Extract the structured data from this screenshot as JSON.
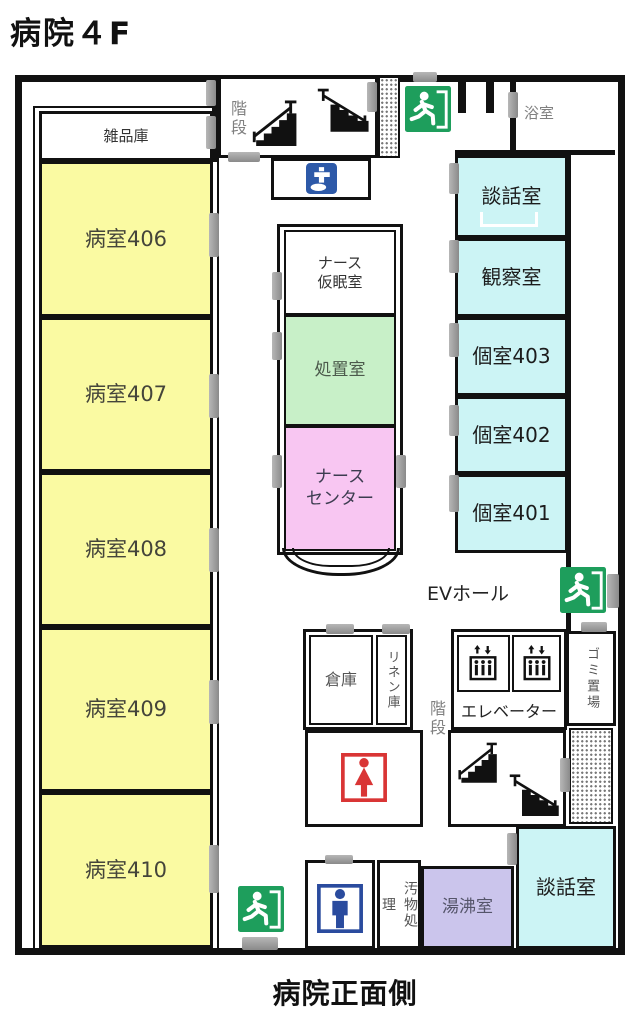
{
  "title": "病院４F",
  "caption": "病院正面側",
  "rooms": {
    "zappinko": "雑品庫",
    "r406": "病室406",
    "r407": "病室407",
    "r408": "病室408",
    "r409": "病室409",
    "r410": "病室410",
    "kaidan_top": "階段",
    "yokushitsu": "浴室",
    "danwa_top": "談話室",
    "kansatsu": "観察室",
    "k403": "個室403",
    "k402": "個室402",
    "k401": "個室401",
    "nurse_nap_line1": "ナース",
    "nurse_nap_line2": "仮眠室",
    "shochi": "処置室",
    "nurse_center_line1": "ナース",
    "nurse_center_line2": "センター",
    "ev_hall": "EVホール",
    "soko": "倉庫",
    "linen": "リネン庫",
    "elevator": "エレベーター",
    "gomi": "ゴミ置場",
    "kaidan_bottom": "階段",
    "obutsu": "汚物処理",
    "yuwakashi": "湯沸室",
    "danwa_bottom": "談話室"
  },
  "icons": {
    "emergency_exit": "emergency-exit-running-man",
    "stairs_up": "stairs-up",
    "stairs_down": "stairs-down",
    "elevator": "elevator-cabin-with-people",
    "female_toilet": "female-toilet",
    "male_toilet": "male-toilet",
    "hand_wash": "hand-washing-faucet"
  },
  "colors": {
    "ward_yellow": "#FAFAA2",
    "room_cyan": "#CCF4F5",
    "treatment_green": "#C8F0C8",
    "nurse_pink": "#F8C6F2",
    "kitchen_lavender": "#CBC5EC",
    "exit_green": "#1E9E5C",
    "male_blue": "#2A4B9E",
    "female_red": "#D93535",
    "wash_blue": "#2D59A8",
    "door_gray": "#9A9A9A",
    "wall_black": "#111111"
  }
}
